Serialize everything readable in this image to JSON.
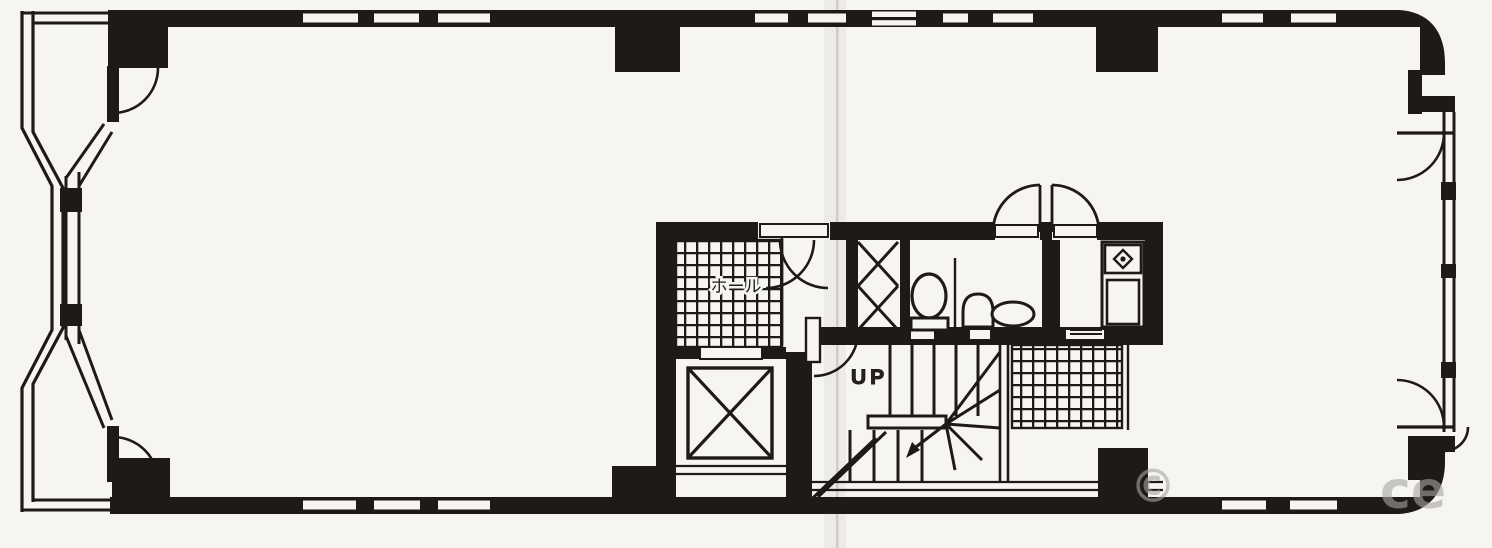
{
  "document": {
    "type": "architectural-floor-plan",
    "style": "scanned black-ink Japanese building floor plan"
  },
  "labels": {
    "hall": "ホール",
    "stairs_up": "UP"
  },
  "watermark": {
    "copyright_symbol": "©",
    "text_fragment": "ce"
  },
  "colors": {
    "ink": "#1d1a17",
    "paper": "#f6f5f2",
    "fold_shadow": "#d9d6d0",
    "watermark": "#a9a6a2"
  },
  "features": [
    "bay-window-left",
    "entry-door-swing",
    "structural-column",
    "window-slot",
    "tiled-elevator-hall",
    "elevator-shaft",
    "pipe-shaft-x-brace",
    "toilet-bowl",
    "urinal",
    "wash-basin",
    "kitchenette-counter",
    "sink-symbol",
    "double-swing-door",
    "staircase-up",
    "winder-treads",
    "tiled-landing",
    "rounded-corner-right"
  ]
}
